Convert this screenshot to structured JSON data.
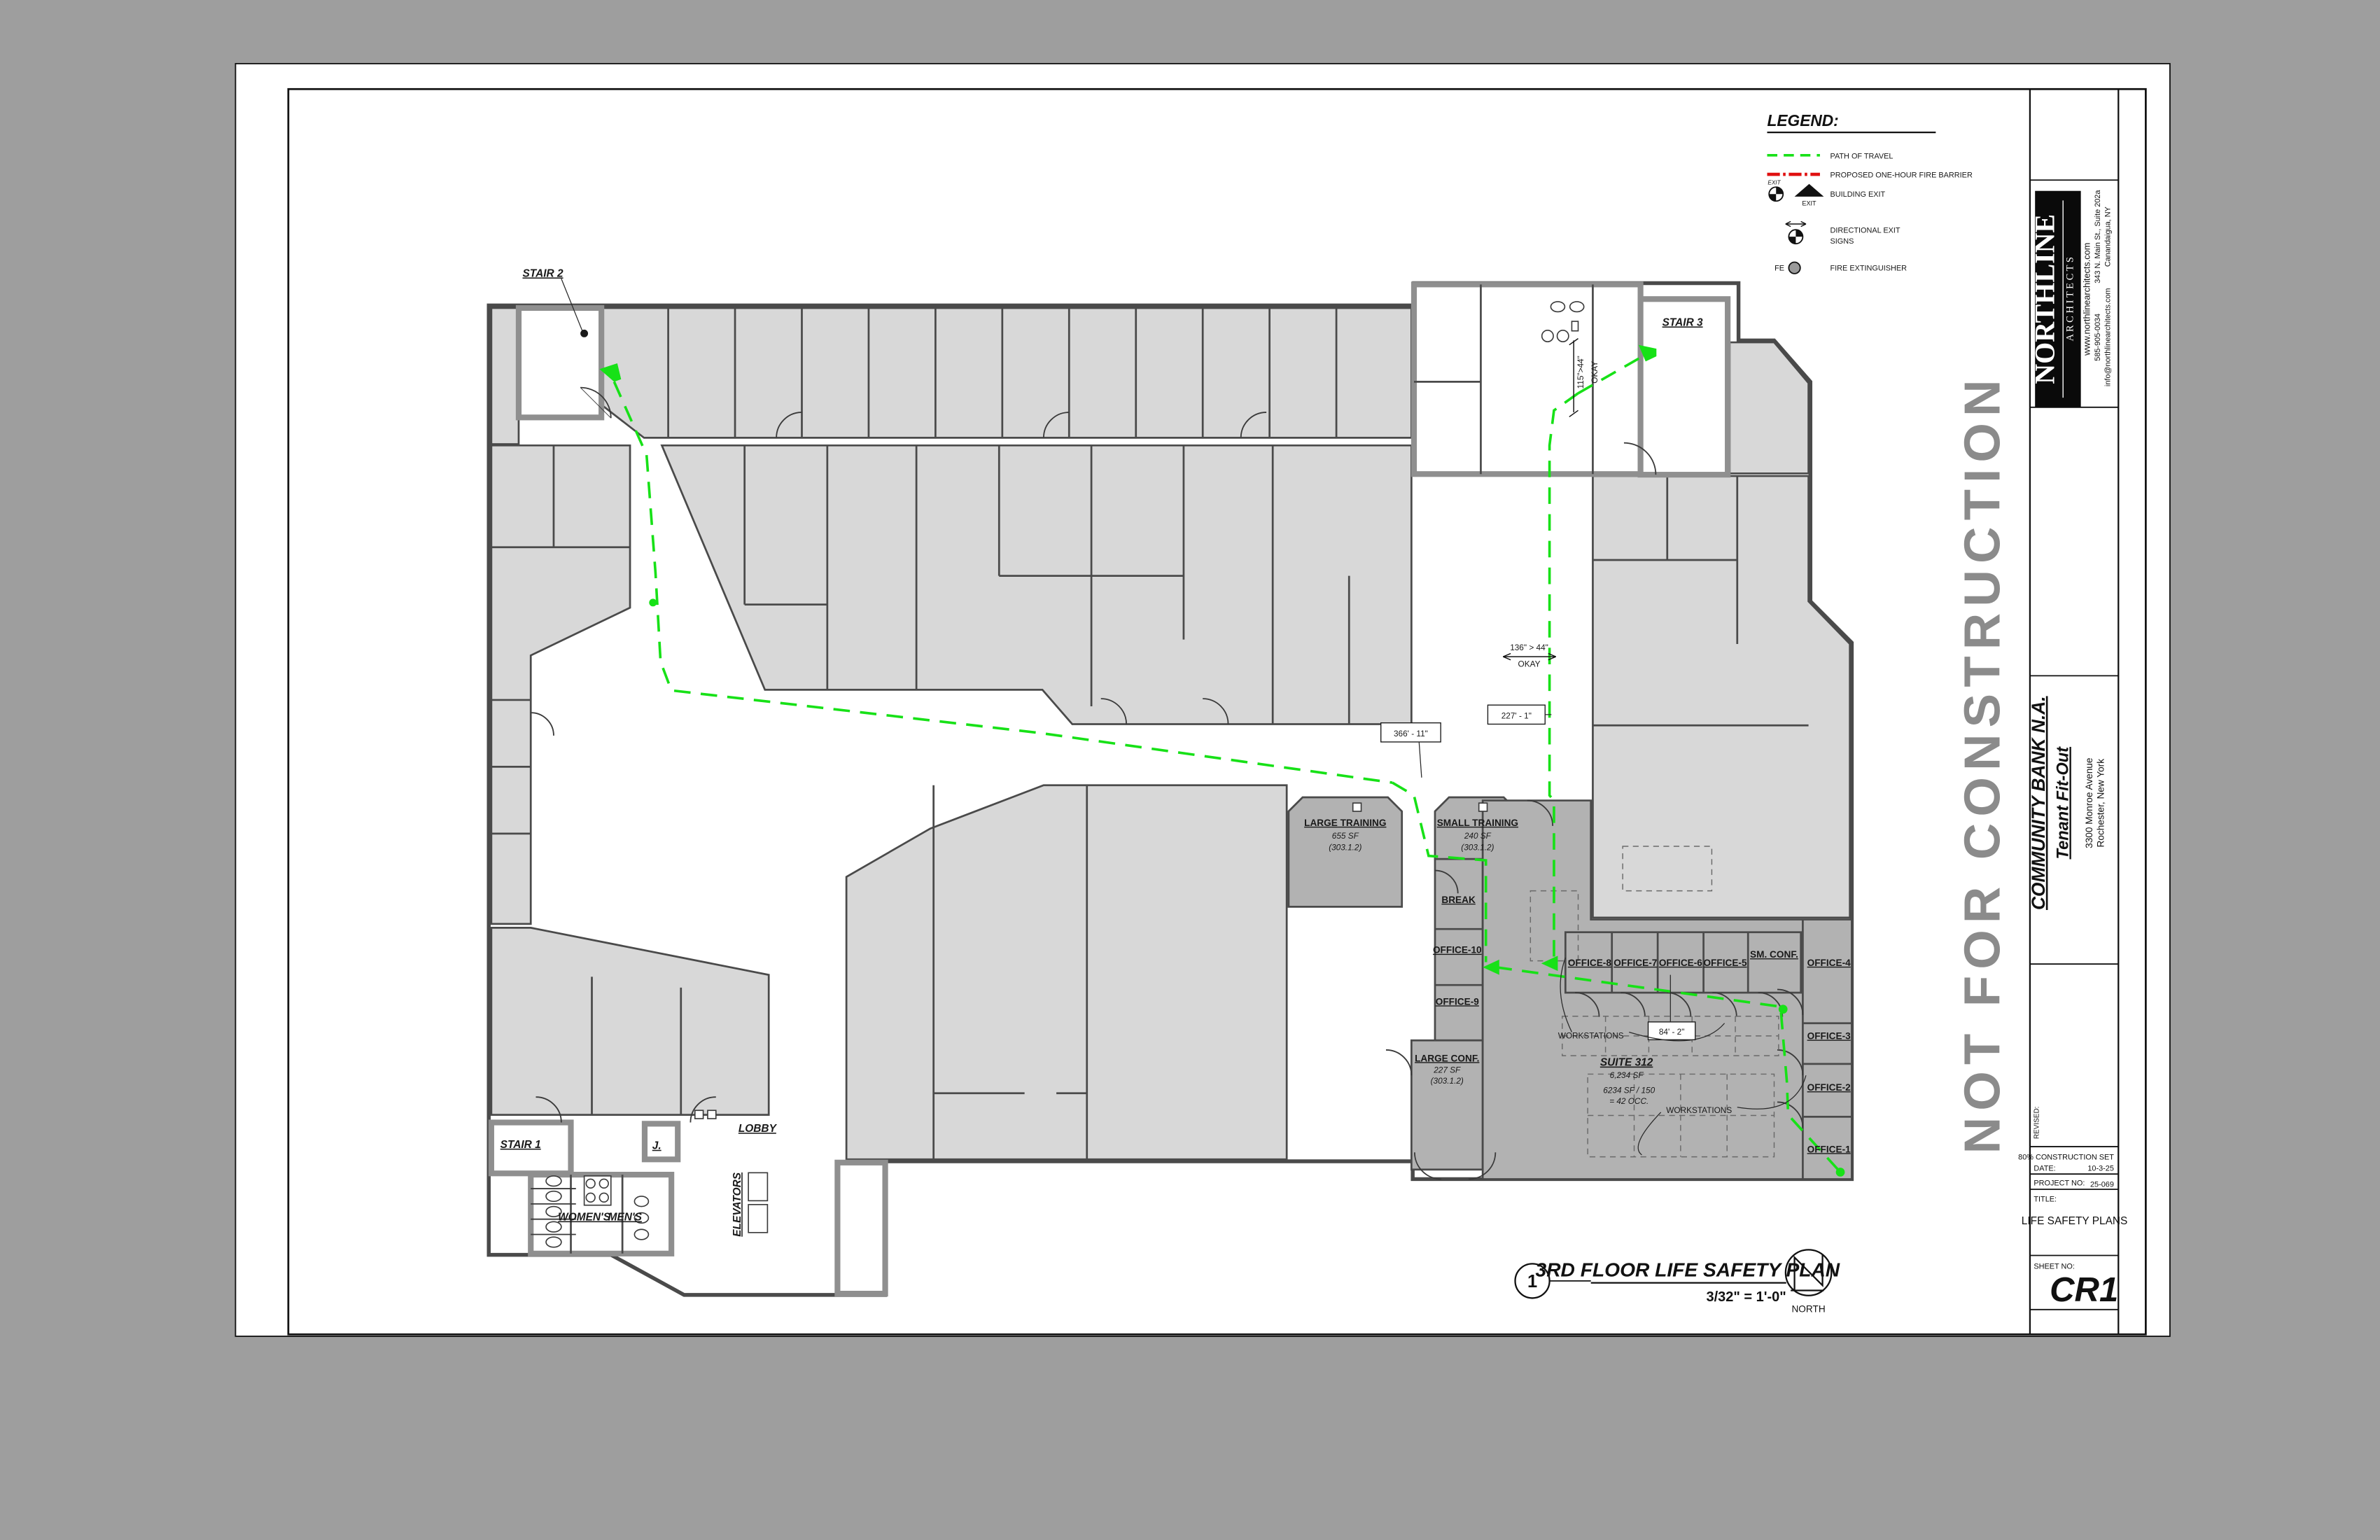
{
  "watermark": "NOT FOR CONSTRUCTION",
  "legend": {
    "title": "LEGEND:",
    "path_of_travel": "PATH OF TRAVEL",
    "fire_barrier": "PROPOSED ONE-HOUR FIRE BARRIER",
    "building_exit": "BUILDING EXIT",
    "exit_word": "EXIT",
    "exit_word_small": "EXIT",
    "directional_line1": "DIRECTIONAL EXIT",
    "directional_line2": "SIGNS",
    "fire_ext_prefix": "FE",
    "fire_extinguisher": "FIRE EXTINGUISHER"
  },
  "title_block": {
    "firm_name": "NORTHLINE",
    "firm_type": "A R C H I T E C T S",
    "website": "www.northlinearchitects.com",
    "address1": "343 N. Main St., Suite 202a",
    "address2": "Canandaigua, NY",
    "phone": "585-905-0034",
    "email": "info@northlinearchitects.com",
    "client": "COMMUNITY BANK N.A.",
    "project": "Tenant Fit-Out",
    "site1": "3300 Monroe Avenue",
    "site2": "Rochester, New York",
    "revised_label": "REVISED:",
    "set_label": "80% CONSTRUCTION SET",
    "date_label": "DATE:",
    "date_value": "10-3-25",
    "project_no_label": "PROJECT NO:",
    "project_no_value": "25-069",
    "title_label": "TITLE:",
    "title_value": "LIFE SAFETY PLANS",
    "sheet_no_label": "SHEET NO:",
    "sheet_no_value": "CR1"
  },
  "view_title": {
    "number": "1",
    "title": "3RD FLOOR LIFE SAFETY PLAN",
    "scale": "3/32\" = 1'-0\"",
    "north": "NORTH"
  },
  "plan": {
    "rooms": {
      "stair1": "STAIR 1",
      "stair2": "STAIR 2",
      "stair3": "STAIR 3",
      "womens": "WOMEN'S",
      "mens": "MEN'S",
      "janitor": "J.",
      "lobby": "LOBBY",
      "elevators": "ELEVATORS",
      "large_training": "LARGE TRAINING",
      "large_training_sf": "655 SF",
      "large_training_code": "(303.1.2)",
      "small_training": "SMALL TRAINING",
      "small_training_sf": "240 SF",
      "small_training_code": "(303.1.2)",
      "break_room": "BREAK",
      "office10": "OFFICE-10",
      "office9": "OFFICE-9",
      "large_conf": "LARGE CONF.",
      "large_conf_sf": "227 SF",
      "large_conf_code": "(303.1.2)",
      "office8": "OFFICE-8",
      "office7": "OFFICE-7",
      "office6": "OFFICE-6",
      "office5": "OFFICE-5",
      "sm_conf": "SM. CONF.",
      "office4": "OFFICE-4",
      "office3": "OFFICE-3",
      "office2": "OFFICE-2",
      "office1": "OFFICE-1",
      "workstations1": "WORKSTATIONS",
      "workstations2": "WORKSTATIONS",
      "suite": "SUITE 312",
      "suite_sf": "6,234 SF",
      "occ_line1": "6234 SF / 150",
      "occ_line2": "= 42 OCC."
    },
    "annotations": {
      "dim_corridor": "136\" > 44\"",
      "dim_corridor_ok": "OKAY",
      "dim_door": "115\">44\"",
      "dim_door_ok": "OKAY",
      "dim_path1": "227' - 1\"",
      "dim_path2": "366' - 11\"",
      "dim_path3": "84' - 2\""
    }
  }
}
